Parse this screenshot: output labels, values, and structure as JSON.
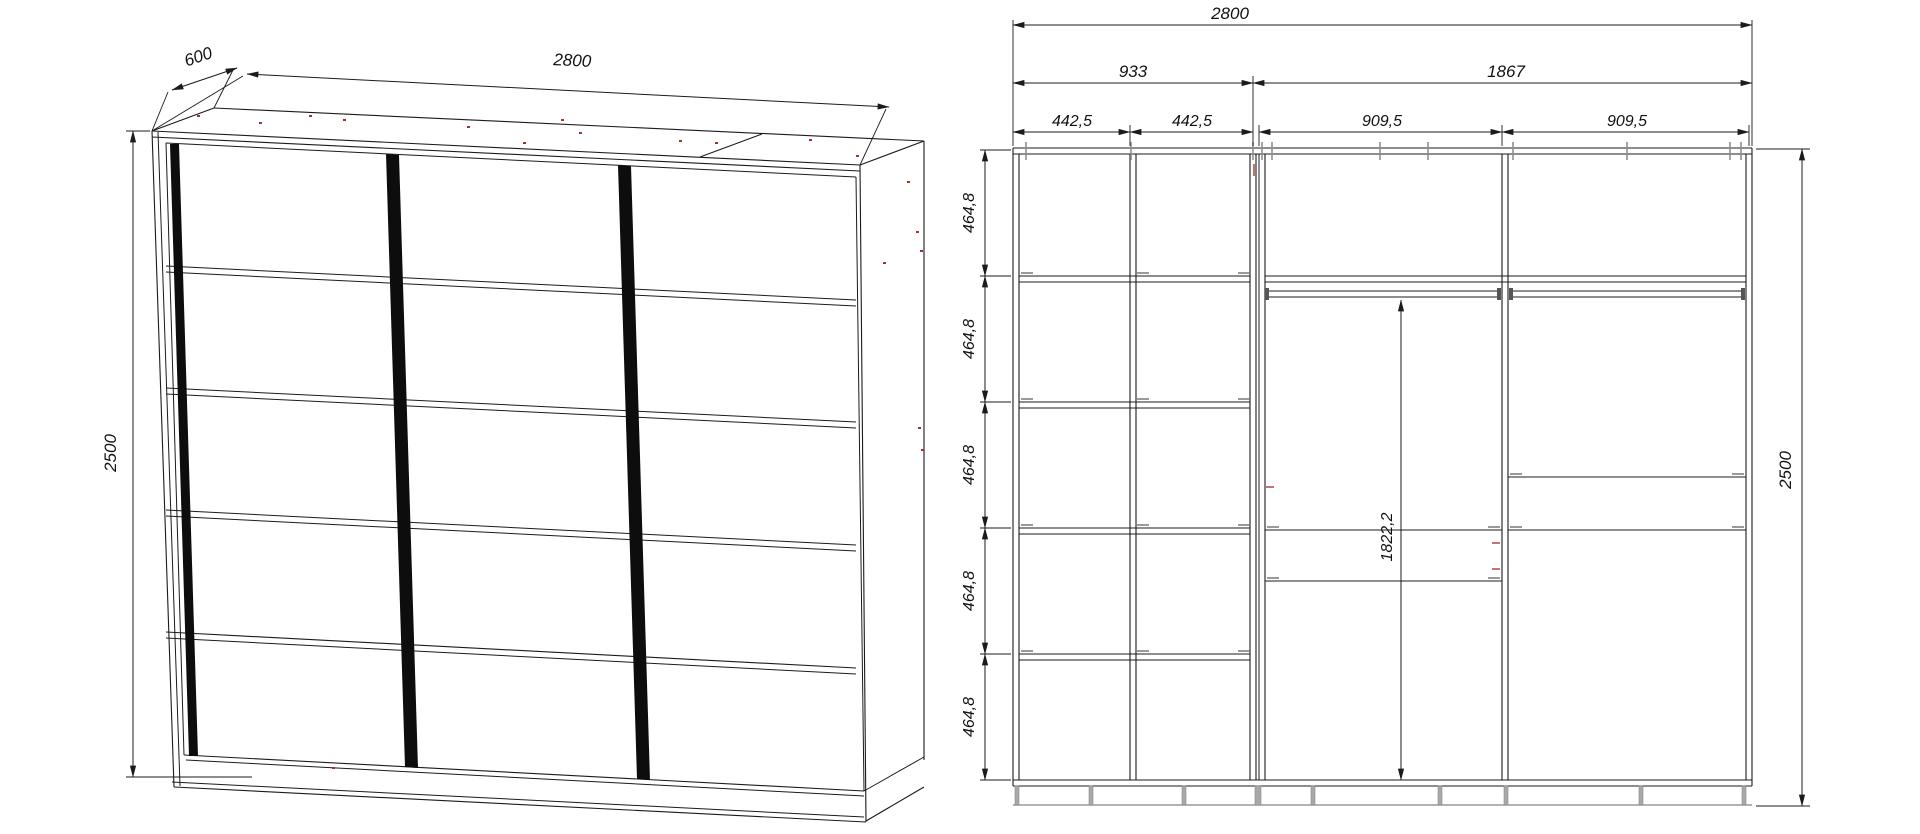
{
  "page": {
    "background": "#ffffff",
    "line_color": "#1b1b1b",
    "hardware_mark_color": "#8f8f8f",
    "assembly_dot_color": "#a13129",
    "plinth_color": "#9a9a9a"
  },
  "perspective_view": {
    "description": "wardrobe-3-sliding-doors-perspective",
    "dims": {
      "width": "2800",
      "depth": "600",
      "height": "2500"
    }
  },
  "elevation_view": {
    "description": "wardrobe-internal-elevation",
    "dims": {
      "total_width": "2800",
      "left_section_width": "933",
      "right_section_width": "1867",
      "left_col_widths": [
        "442,5",
        "442,5"
      ],
      "right_col_widths": [
        "909,5",
        "909,5"
      ],
      "row_heights": [
        "464,8",
        "464,8",
        "464,8",
        "464,8",
        "464,8"
      ],
      "hanging_height": "1822,2",
      "total_height": "2500"
    }
  }
}
